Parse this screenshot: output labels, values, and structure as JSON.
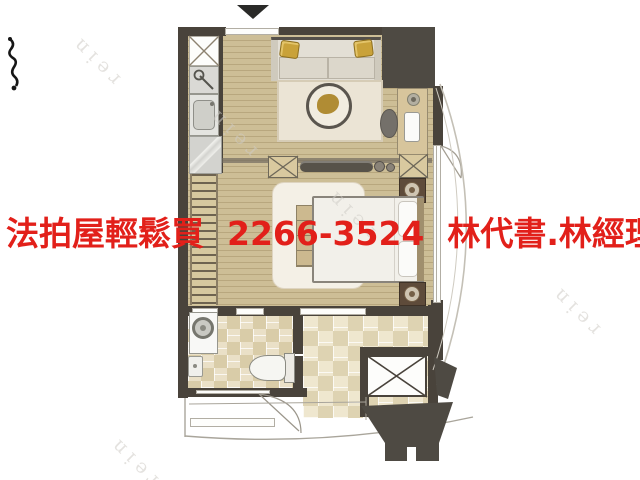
{
  "ad_overlay": {
    "text": "法拍屋輕鬆買  2266-3524  林代書.林經理",
    "phone": "2266-3524",
    "color": "#e2201a"
  },
  "watermark": {
    "text": "rein"
  },
  "palette": {
    "background": "#ffffff",
    "wall": "#49433b",
    "structure_block": "#4e4a43",
    "wood_floor": "#cabb92",
    "wood_strip": "#b8a77e",
    "tile_light": "#eae0c7",
    "tile_shadow": "#d9cca8",
    "gold_accent": "#c9a23a",
    "ad_red": "#e2201a"
  }
}
